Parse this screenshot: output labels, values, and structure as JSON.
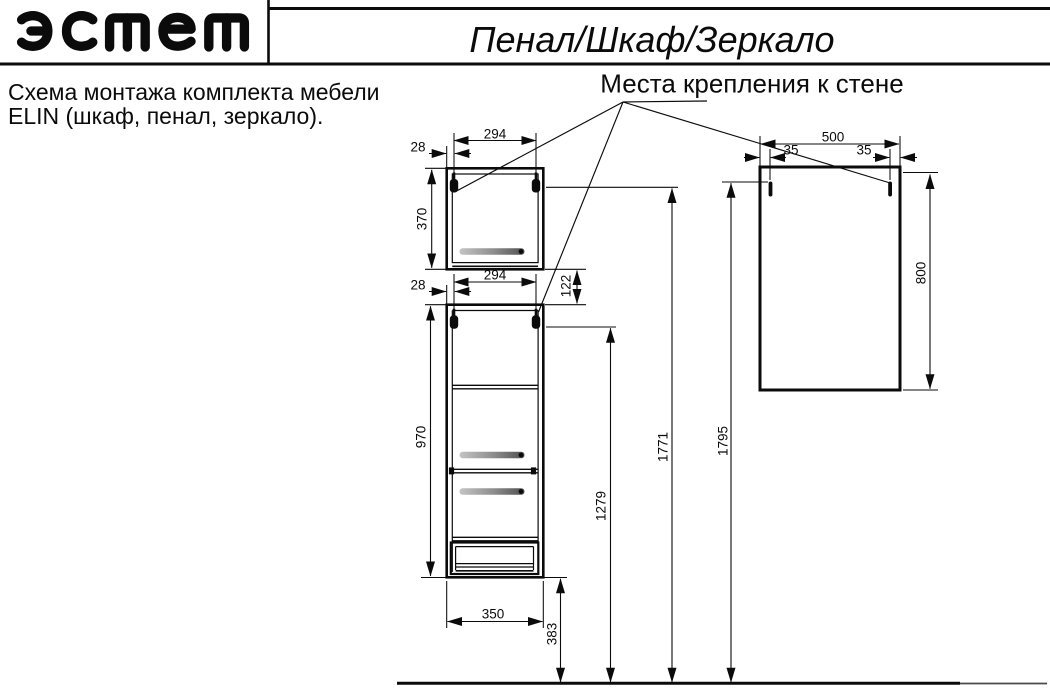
{
  "header": {
    "logo_text": "эстет",
    "title": "Пенал/Шкаф/Зеркало"
  },
  "note": {
    "line1": "Схема монтажа комплекта мебели",
    "line2": "ELIN (шкаф, пенал, зеркало)."
  },
  "annotation": {
    "wall_mount_label": "Места крепления к стене"
  },
  "dims": {
    "upper_width_294": "294",
    "upper_offset_28": "28",
    "upper_height_370": "370",
    "lower_width_294": "294",
    "lower_offset_28": "28",
    "gap_122": "122",
    "lower_height_970": "970",
    "base_width_350": "350",
    "floor_gap_383": "383",
    "mount_1279": "1279",
    "mount_1771": "1771",
    "mount_1795": "1795",
    "mirror_width_500": "500",
    "mirror_offset_left_35": "35",
    "mirror_offset_right_35": "35",
    "mirror_height_800": "800"
  },
  "colors": {
    "line": "#0b0b0b",
    "handle_light": "#c4c4c4",
    "handle_dark": "#4f4f4f"
  }
}
